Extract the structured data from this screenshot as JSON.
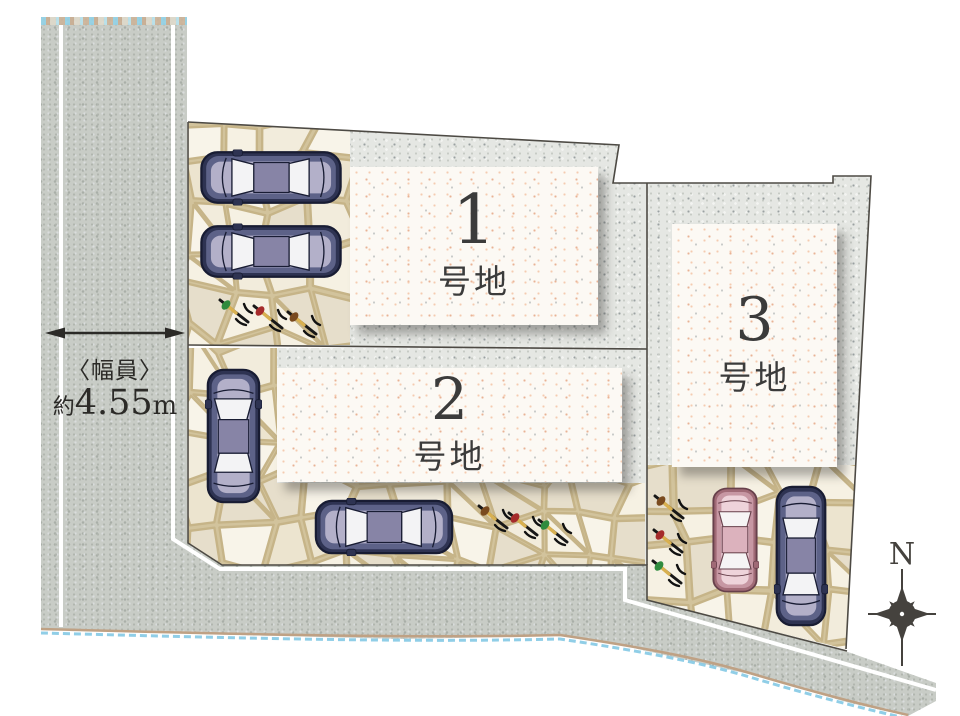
{
  "plan": {
    "kind": "site-plan"
  },
  "road": {
    "width_label": "〈幅員〉",
    "width_prefix": "約",
    "width_value": "4.55",
    "width_unit": "m"
  },
  "lots": [
    {
      "number": "1",
      "suffix": "号地"
    },
    {
      "number": "2",
      "suffix": "号地"
    },
    {
      "number": "3",
      "suffix": "号地"
    }
  ],
  "compass": {
    "north": "N"
  },
  "colors": {
    "road_gray": "#c8ccc6",
    "lot_gray": "#e5e7e3",
    "building_paper": "#fcf9f4",
    "boundary_line": "#4d4a44",
    "road_line_white": "#ffffff",
    "water_blue": "#7cc6e3",
    "shore_tan": "#bfa184",
    "stone_grout": "#d2c39c",
    "compass_ink": "#45423e",
    "car_navy": {
      "outer": "#2e3352",
      "stroke": "#181c33",
      "inner": "#5d6288",
      "center": "#b3b0c9",
      "roof": "#8784a6",
      "glass": "#f3f3f5"
    },
    "car_pink": {
      "outer": "#a06a76",
      "stroke": "#67404b",
      "inner": "#c797a3",
      "center": "#eed3da",
      "roof": "#dcb2bd",
      "glass": "#f6f4f4"
    },
    "leaf_green": "#2f8b3e",
    "leaf_red": "#a52b2b",
    "leaf_brown": "#7a4a1e"
  }
}
